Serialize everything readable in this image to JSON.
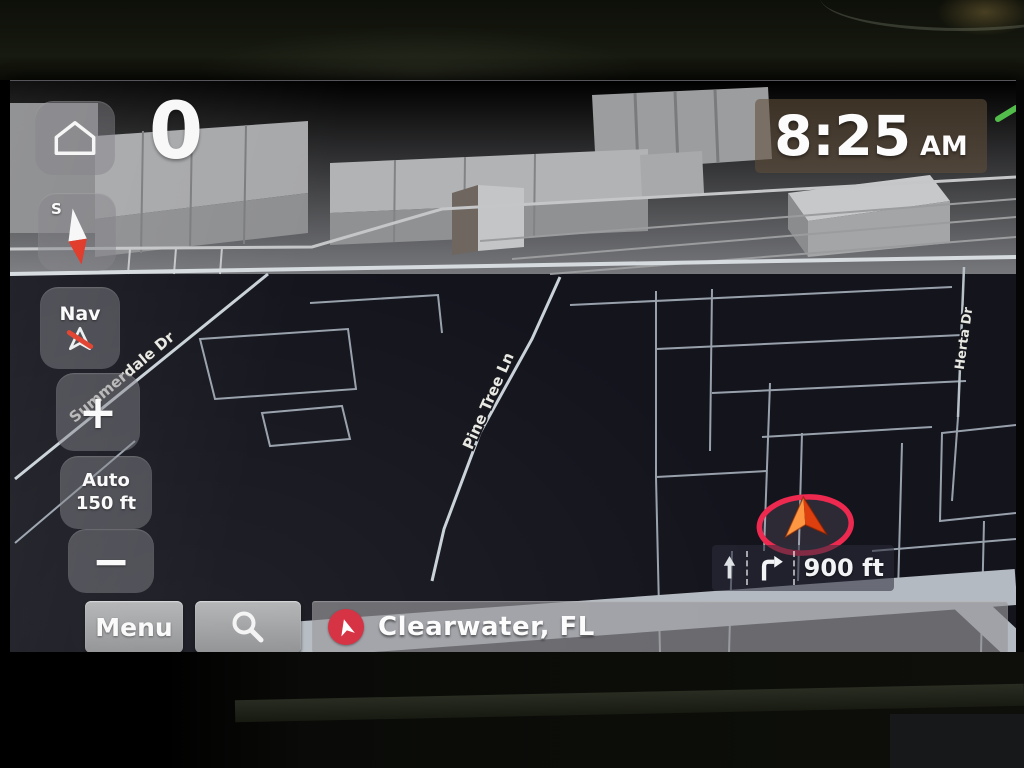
{
  "hud": {
    "speed": "0",
    "time": {
      "value": "8:25",
      "period": "AM"
    },
    "compass": {
      "letter": "S"
    },
    "nav_button": {
      "label": "Nav"
    },
    "zoom_in": "+",
    "zoom_out": "−",
    "scale_button": {
      "mode": "Auto",
      "value": "150 ft"
    },
    "maneuver": {
      "distance": "900 ft"
    },
    "bottom_bar": {
      "menu": "Menu",
      "destination": "Clearwater, FL"
    }
  },
  "map": {
    "street_labels": [
      {
        "name": "Summerdale Dr"
      },
      {
        "name": "Pine Tree Ln"
      },
      {
        "name": "Herta Dr"
      }
    ]
  },
  "icons": {
    "home": "home-icon",
    "compass_needle": "compass-needle-icon",
    "nav_voice_muted": "nav-voice-mute-icon",
    "search": "search-icon",
    "destination_marker": "location-arrow-icon",
    "vehicle_position": "vehicle-position-icon",
    "lane_straight": "lane-straight-arrow-icon",
    "lane_right_turn": "lane-right-turn-arrow-icon"
  },
  "colors": {
    "map_background": "#14141d",
    "road": "#98a1ab",
    "road_major": "#b4bac1",
    "horizon_ground": "#87888b",
    "accent_red_ring": "#ee2950",
    "marker_orange": "#dd3f0e",
    "destination_red": "#d42b3e",
    "route_green": "#53bd4b",
    "time_badge": "rgba(96,77,56,0.58)"
  }
}
